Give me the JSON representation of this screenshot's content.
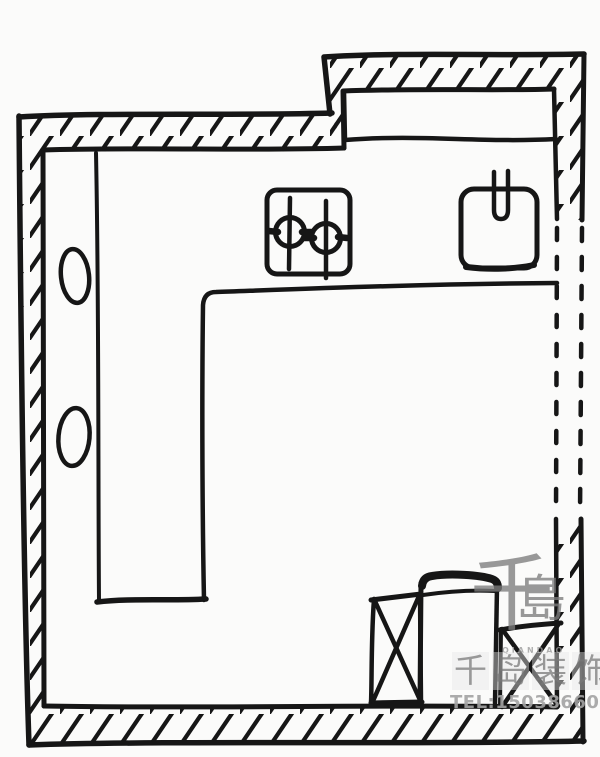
{
  "canvas": {
    "width": 600,
    "height": 757,
    "background_color": "#fbfbfa",
    "ink_color": "#161616",
    "description": "Hand-drawn kitchen floor plan sketch, black ink on white"
  },
  "plan_elements": {
    "walls": "hatched-double-line-walls",
    "right_wall_opening": "dashed-parallel-lines",
    "counter": "l-shaped-counter-outline",
    "top_window_band": "long-rectangle-along-top-wall",
    "stove": "two-burner-cooktop-square",
    "burners": [
      "crosshair-burner",
      "crosshair-burner"
    ],
    "sink": "rounded-square-basin",
    "faucet": "small-tap-stub",
    "left_counter_items": [
      "hand-drawn-oval",
      "hand-drawn-oval"
    ],
    "bottom_right_items": [
      "crossed-box-appliance",
      "refrigerator-box",
      "crossed-box-appliance"
    ]
  },
  "watermark": {
    "logo_main_char": "千",
    "logo_secondary_char": "島",
    "logo_subtext": "QIANDAO",
    "company_name": "千岛装饰",
    "company_chars": [
      "千",
      "岛",
      "装",
      "饰"
    ],
    "phone": "TEL:15038660207",
    "text_color": "#8f8f8f"
  }
}
